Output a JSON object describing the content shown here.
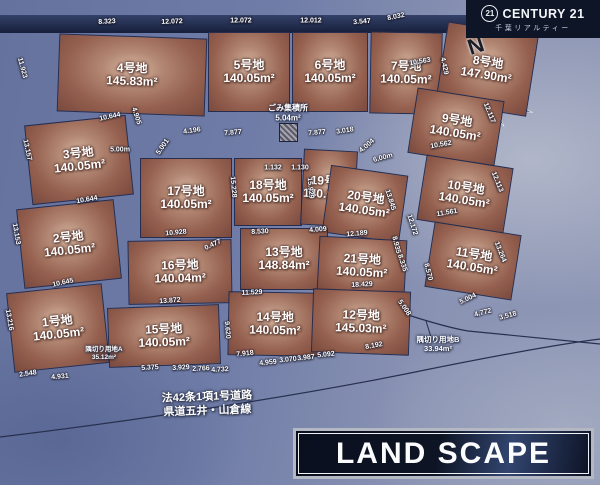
{
  "colors": {
    "road_blue": "#7380aa",
    "plot_brown": "#95604f",
    "band_navy": "#1b2440",
    "brand_bg": "#0d1527",
    "landscape_bg": "#0b1120",
    "label_white": "#ffffff"
  },
  "brand": {
    "badge": "21",
    "name": "CENTURY 21",
    "sub": "千葉リアルティー"
  },
  "compass": {
    "label": "N"
  },
  "road": {
    "line1": "法42条1項1号道路",
    "line2": "県道五井・山倉線"
  },
  "footer_logo": {
    "text": "LAND SCAPE"
  },
  "map": {
    "facilities": {
      "garbage": {
        "label": "ごみ集積所",
        "area": "5.04m²"
      },
      "corner_a": {
        "label": "隅切り用地A",
        "area": "35.12m²"
      },
      "corner_b": {
        "label": "隅切り用地B",
        "area": "33.94m²"
      }
    },
    "plots": [
      {
        "name": "4号地",
        "area": "145.83m²",
        "x": 58,
        "y": 36,
        "w": 148,
        "h": 78,
        "r": 2
      },
      {
        "name": "5号地",
        "area": "140.05m²",
        "x": 208,
        "y": 32,
        "w": 82,
        "h": 80,
        "r": 0
      },
      {
        "name": "6号地",
        "area": "140.05m²",
        "x": 292,
        "y": 32,
        "w": 76,
        "h": 80,
        "r": 0
      },
      {
        "name": "7号地",
        "area": "140.05m²",
        "x": 370,
        "y": 32,
        "w": 72,
        "h": 82,
        "r": 1
      },
      {
        "name": "8号地",
        "area": "147.90m²",
        "x": 441,
        "y": 28,
        "w": 92,
        "h": 82,
        "r": 9
      },
      {
        "name": "9号地",
        "area": "140.05m²",
        "x": 412,
        "y": 94,
        "w": 88,
        "h": 66,
        "r": 9
      },
      {
        "name": "10号地",
        "area": "140.05m²",
        "x": 421,
        "y": 161,
        "w": 88,
        "h": 66,
        "r": 9
      },
      {
        "name": "11号地",
        "area": "140.05m²",
        "x": 429,
        "y": 228,
        "w": 88,
        "h": 66,
        "r": 9
      },
      {
        "name": "3号地",
        "area": "140.05m²",
        "x": 28,
        "y": 120,
        "w": 102,
        "h": 80,
        "r": -6
      },
      {
        "name": "2号地",
        "area": "140.05m²",
        "x": 20,
        "y": 204,
        "w": 98,
        "h": 80,
        "r": -6
      },
      {
        "name": "1号地",
        "area": "140.05m²",
        "x": 10,
        "y": 288,
        "w": 96,
        "h": 80,
        "r": -6
      },
      {
        "name": "17号地",
        "area": "140.05m²",
        "x": 140,
        "y": 158,
        "w": 92,
        "h": 80,
        "r": 0
      },
      {
        "name": "18号地",
        "area": "140.05m²",
        "x": 234,
        "y": 158,
        "w": 68,
        "h": 68,
        "r": 0
      },
      {
        "name": "19号地",
        "area": "140.05m²",
        "x": 302,
        "y": 150,
        "w": 54,
        "h": 76,
        "r": 3
      },
      {
        "name": "20号地",
        "area": "140.05m²",
        "x": 326,
        "y": 170,
        "w": 78,
        "h": 68,
        "r": 8
      },
      {
        "name": "16号地",
        "area": "140.04m²",
        "x": 128,
        "y": 240,
        "w": 104,
        "h": 64,
        "r": -1
      },
      {
        "name": "13号地",
        "area": "148.84m²",
        "x": 240,
        "y": 228,
        "w": 88,
        "h": 62,
        "r": 0
      },
      {
        "name": "21号地",
        "area": "140.05m²",
        "x": 318,
        "y": 238,
        "w": 88,
        "h": 56,
        "r": 3
      },
      {
        "name": "15号地",
        "area": "140.05m²",
        "x": 108,
        "y": 306,
        "w": 112,
        "h": 60,
        "r": -2
      },
      {
        "name": "14号地",
        "area": "140.05m²",
        "x": 228,
        "y": 292,
        "w": 94,
        "h": 64,
        "r": 1
      },
      {
        "name": "12号地",
        "area": "145.03m²",
        "x": 312,
        "y": 290,
        "w": 98,
        "h": 64,
        "r": 2
      }
    ],
    "dimensions": [
      {
        "t": "8.323",
        "x": 107,
        "y": 22,
        "r": -3
      },
      {
        "t": "12.072",
        "x": 172,
        "y": 22,
        "r": -2
      },
      {
        "t": "12.072",
        "x": 241,
        "y": 21,
        "r": 0
      },
      {
        "t": "12.012",
        "x": 311,
        "y": 21,
        "r": 0
      },
      {
        "t": "3.547",
        "x": 362,
        "y": 22,
        "r": -5
      },
      {
        "t": "8.032",
        "x": 396,
        "y": 17,
        "r": -12
      },
      {
        "t": "4.429",
        "x": 444,
        "y": 66,
        "r": 78
      },
      {
        "t": "10.563",
        "x": 420,
        "y": 62,
        "r": -10
      },
      {
        "t": "12.117",
        "x": 489,
        "y": 113,
        "r": 68
      },
      {
        "t": "10.562",
        "x": 441,
        "y": 145,
        "r": -10
      },
      {
        "t": "12.113",
        "x": 497,
        "y": 182,
        "r": 68
      },
      {
        "t": "11.561",
        "x": 447,
        "y": 213,
        "r": -10
      },
      {
        "t": "13.264",
        "x": 500,
        "y": 252,
        "r": 68
      },
      {
        "t": "5.004",
        "x": 468,
        "y": 299,
        "r": -25
      },
      {
        "t": "4.772",
        "x": 483,
        "y": 313,
        "r": -15
      },
      {
        "t": "3.518",
        "x": 508,
        "y": 316,
        "r": -15
      },
      {
        "t": "11.923",
        "x": 22,
        "y": 68,
        "r": 75
      },
      {
        "t": "10.644",
        "x": 110,
        "y": 117,
        "r": -12
      },
      {
        "t": "13.157",
        "x": 27,
        "y": 150,
        "r": 78
      },
      {
        "t": "10.644",
        "x": 87,
        "y": 200,
        "r": -10
      },
      {
        "t": "13.153",
        "x": 16,
        "y": 234,
        "r": 80
      },
      {
        "t": "10.645",
        "x": 63,
        "y": 283,
        "r": -12
      },
      {
        "t": "13.216",
        "x": 9,
        "y": 320,
        "r": 80
      },
      {
        "t": "2.548",
        "x": 28,
        "y": 374,
        "r": -8
      },
      {
        "t": "4.931",
        "x": 60,
        "y": 377,
        "r": -5
      },
      {
        "t": "4.905",
        "x": 136,
        "y": 116,
        "r": 72
      },
      {
        "t": "5.00m",
        "x": 120,
        "y": 150,
        "r": 0
      },
      {
        "t": "5.001",
        "x": 163,
        "y": 147,
        "r": -55
      },
      {
        "t": "4.196",
        "x": 192,
        "y": 131,
        "r": -8
      },
      {
        "t": "7.877",
        "x": 233,
        "y": 133,
        "r": -5
      },
      {
        "t": "7.877",
        "x": 317,
        "y": 133,
        "r": -5
      },
      {
        "t": "3.018",
        "x": 345,
        "y": 131,
        "r": -8
      },
      {
        "t": "4.004",
        "x": 367,
        "y": 146,
        "r": -40
      },
      {
        "t": "6.00m",
        "x": 383,
        "y": 158,
        "r": -15
      },
      {
        "t": "1.132",
        "x": 273,
        "y": 168,
        "r": 0
      },
      {
        "t": "1.130",
        "x": 300,
        "y": 168,
        "r": 0
      },
      {
        "t": "15.228",
        "x": 233,
        "y": 187,
        "r": 85
      },
      {
        "t": "15.929",
        "x": 310,
        "y": 188,
        "r": 85
      },
      {
        "t": "13.845",
        "x": 390,
        "y": 200,
        "r": 72
      },
      {
        "t": "12.172",
        "x": 412,
        "y": 225,
        "r": 72
      },
      {
        "t": "10.928",
        "x": 176,
        "y": 233,
        "r": -5
      },
      {
        "t": "0.477",
        "x": 213,
        "y": 245,
        "r": -25
      },
      {
        "t": "8.530",
        "x": 260,
        "y": 232,
        "r": -3
      },
      {
        "t": "4.009",
        "x": 318,
        "y": 230,
        "r": -5
      },
      {
        "t": "12.189",
        "x": 357,
        "y": 234,
        "r": -5
      },
      {
        "t": "8.935",
        "x": 396,
        "y": 245,
        "r": 75
      },
      {
        "t": "8.335",
        "x": 402,
        "y": 263,
        "r": 72
      },
      {
        "t": "8.570",
        "x": 428,
        "y": 272,
        "r": 75
      },
      {
        "t": "13.872",
        "x": 170,
        "y": 301,
        "r": -4
      },
      {
        "t": "11.529",
        "x": 252,
        "y": 293,
        "r": -3
      },
      {
        "t": "18.429",
        "x": 362,
        "y": 285,
        "r": -3
      },
      {
        "t": "9.620",
        "x": 227,
        "y": 330,
        "r": 85
      },
      {
        "t": "5.008",
        "x": 404,
        "y": 308,
        "r": 55
      },
      {
        "t": "7.918",
        "x": 245,
        "y": 354,
        "r": -6
      },
      {
        "t": "5.375",
        "x": 150,
        "y": 368,
        "r": -3
      },
      {
        "t": "3.929",
        "x": 181,
        "y": 368,
        "r": -3
      },
      {
        "t": "2.766",
        "x": 201,
        "y": 369,
        "r": -3
      },
      {
        "t": "4.732",
        "x": 220,
        "y": 370,
        "r": -3
      },
      {
        "t": "4.959",
        "x": 268,
        "y": 363,
        "r": -6
      },
      {
        "t": "3.070",
        "x": 288,
        "y": 360,
        "r": -6
      },
      {
        "t": "3.987",
        "x": 306,
        "y": 358,
        "r": -6
      },
      {
        "t": "5.092",
        "x": 326,
        "y": 355,
        "r": -6
      },
      {
        "t": "8.192",
        "x": 374,
        "y": 346,
        "r": -10
      }
    ]
  }
}
